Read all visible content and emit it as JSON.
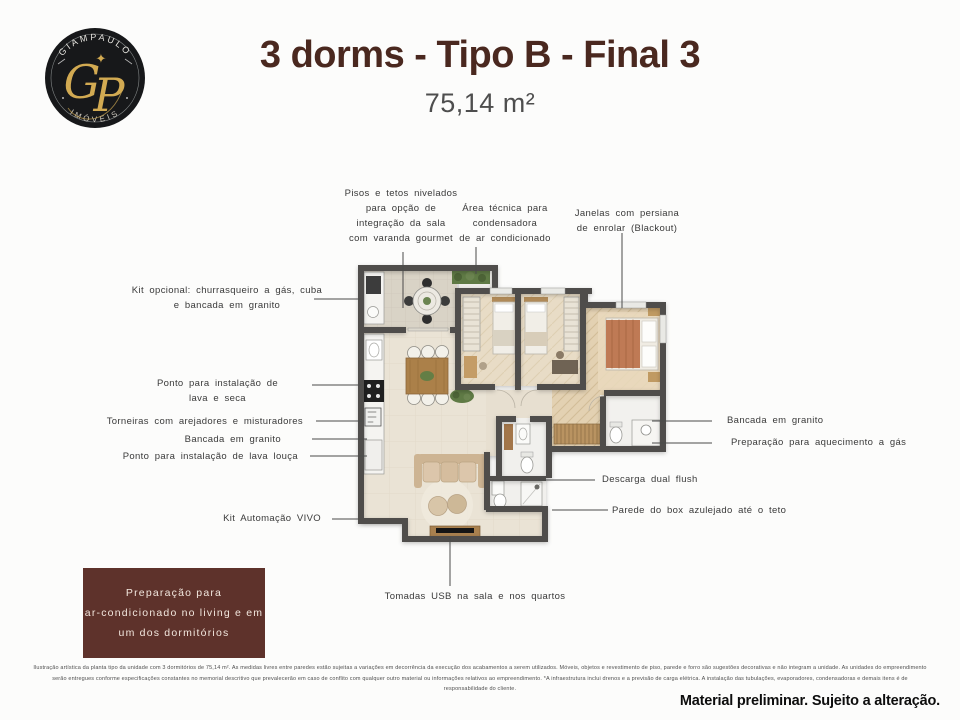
{
  "logo": {
    "name_top": "GIAMPAULO",
    "name_bottom": "IMÓVEIS",
    "monogram_g": "G",
    "monogram_p": "P",
    "sparkle": "✦",
    "colors": {
      "circle": "#17181a",
      "gold": "#d2aa52"
    }
  },
  "header": {
    "title": "3 dorms - Tipo B - Final 3",
    "area": "75,14 m²"
  },
  "annotations": {
    "pisos": [
      "Pisos e tetos nivelados",
      "para opção de",
      "integração da sala",
      "com varanda gourmet"
    ],
    "area_tecnica": [
      "Área técnica para",
      "condensadora",
      "de ar condicionado"
    ],
    "janelas": [
      "Janelas com persiana",
      "de enrolar (Blackout)"
    ],
    "kit_opcional": [
      "Kit opcional: churrasqueiro a gás, cuba",
      "e bancada em granito"
    ],
    "lava_seca": [
      "Ponto para instalação de",
      "lava e seca"
    ],
    "torneiras": "Torneiras com arejadores e misturadores",
    "bancada_esq": "Bancada em granito",
    "lava_louca": "Ponto para instalação de lava louça",
    "kit_automacao": "Kit Automação VIVO",
    "bancada_dir": "Bancada em granito",
    "aquecimento": "Preparação para aquecimento a gás",
    "descarga": "Descarga dual flush",
    "parede_box": "Parede do box azulejado até o teto",
    "tomadas": "Tomadas USB na sala e nos quartos"
  },
  "highlight_box": {
    "lines": [
      "Preparação para",
      "ar-condicionado no living e em",
      "um dos dormitórios"
    ],
    "bg": "#5e322b"
  },
  "disclaimer": {
    "lines": [
      "Ilustração artística da planta tipo da unidade com 3 dormitórios de 75,14 m². As medidas livres entre paredes estão sujeitas a variações em decorrência da execução dos acabamentos a serem utilizados. Móveis, objetos e revestimento de piso, parede e forro são sugestões decorativas e não integram a unidade. As unidades do empreendimento",
      "serão entregues conforme especificações constantes no memorial descritivo que prevalecerão em caso de conflito com qualquer outro material ou informações relativos ao empreendimento. *A infraestrutura inclui drenos e a previsão de carga elétrica. A instalação das tubulações, evaporadores, condensadoras e demais itens é de",
      "responsabilidade do cliente."
    ],
    "notice": "Material preliminar. Sujeito a alteração."
  }
}
